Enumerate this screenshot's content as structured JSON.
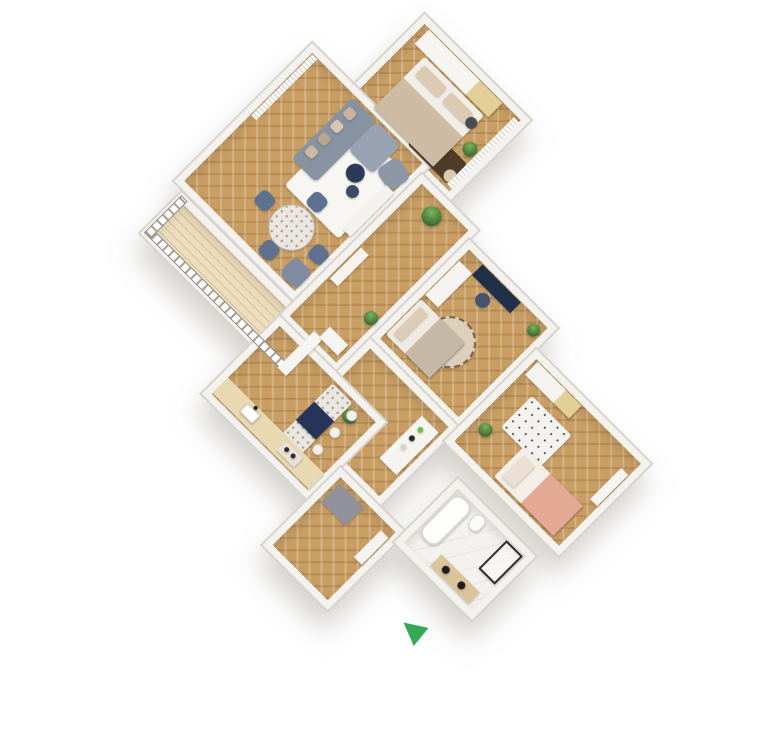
{
  "scene": {
    "description": "3D rendered top-down floor plan of a furnished apartment, rotated diagonally on a white background",
    "background_color": "#ffffff",
    "rotation_deg": 45
  },
  "colors": {
    "wall": "#f3f2ef",
    "wall_edge": "#d7d4ce",
    "wood_floor": "#c99e63",
    "balcony_deck": "#ecddbd",
    "marble_floor": "#f3f2ef",
    "sofa_gray": "#8793a3",
    "navy_accent": "#26345a",
    "beige_textile": "#cdbba4",
    "salmon_textile": "#e3a995",
    "plant_green": "#4c8a42",
    "marker_green": "#34a853"
  },
  "plan": {
    "x": 105,
    "y": 78,
    "width": 560,
    "height": 500,
    "rotation_deg": 45
  },
  "marker": {
    "name": "direction-marker",
    "color": "#34a853",
    "x": 400,
    "y": 614,
    "w": 32,
    "h": 34
  },
  "rooms": [
    {
      "id": "master-bedroom",
      "label": "Master bedroom",
      "floor": "wood",
      "x": 86,
      "y": 0,
      "w": 150,
      "h": 115
    },
    {
      "id": "living-room",
      "label": "Living room",
      "floor": "wood",
      "x": 27,
      "y": 100,
      "w": 170,
      "h": 195
    },
    {
      "id": "balcony",
      "label": "Balcony",
      "floor": "deck",
      "x": 40,
      "y": 298,
      "w": 205,
      "h": 58
    },
    {
      "id": "hallway",
      "label": "Hallway",
      "floor": "wood",
      "x": 197,
      "y": 115,
      "w": 80,
      "h": 201
    },
    {
      "id": "bedroom-2",
      "label": "Bedroom 2",
      "floor": "wood",
      "x": 277,
      "y": 128,
      "w": 125,
      "h": 140
    },
    {
      "id": "corridor",
      "label": "Corridor",
      "floor": "wood",
      "x": 277,
      "y": 268,
      "w": 125,
      "h": 112
    },
    {
      "id": "kitchen",
      "label": "Kitchen",
      "floor": "wood",
      "x": 197,
      "y": 316,
      "w": 150,
      "h": 110
    },
    {
      "id": "entrance",
      "label": "Entrance",
      "floor": "wood",
      "x": 347,
      "y": 380,
      "w": 92,
      "h": 110
    },
    {
      "id": "kids-room",
      "label": "Kids bedroom",
      "floor": "wood",
      "x": 402,
      "y": 158,
      "w": 162,
      "h": 130
    },
    {
      "id": "bathroom",
      "label": "Bathroom",
      "floor": "marble",
      "x": 438,
      "y": 305,
      "w": 110,
      "h": 90
    }
  ],
  "furniture": [
    {
      "name": "wardrobe-master",
      "room": "master-bedroom",
      "shape": "rect",
      "x": 100,
      "y": 8,
      "w": 104,
      "h": 20,
      "color": "#f7f5f2"
    },
    {
      "name": "wardrobe-master-wood",
      "room": "master-bedroom",
      "shape": "rect",
      "x": 172,
      "y": 8,
      "w": 32,
      "h": 20,
      "color": "#e2cf96"
    },
    {
      "name": "rug-master",
      "room": "master-bedroom",
      "shape": "rect",
      "x": 166,
      "y": 76,
      "w": 56,
      "h": 28,
      "color": "#4e3b2a",
      "r": 3
    },
    {
      "name": "bed-master",
      "room": "master-bedroom",
      "shape": "rect",
      "x": 116,
      "y": 30,
      "w": 84,
      "h": 72,
      "color": "#f1eee8",
      "r": 3
    },
    {
      "name": "pillow-master-1",
      "room": "master-bedroom",
      "shape": "rect",
      "x": 122,
      "y": 36,
      "w": 32,
      "h": 14,
      "color": "#dccbb2",
      "r": 3
    },
    {
      "name": "pillow-master-2",
      "room": "master-bedroom",
      "shape": "rect",
      "x": 160,
      "y": 36,
      "w": 32,
      "h": 14,
      "color": "#dccbb2",
      "r": 3
    },
    {
      "name": "blanket-master",
      "room": "master-bedroom",
      "shape": "rect",
      "x": 116,
      "y": 60,
      "w": 84,
      "h": 42,
      "color": "#cdbba4"
    },
    {
      "name": "plant-master",
      "room": "master-bedroom",
      "shape": "circle",
      "x": 206,
      "y": 56,
      "d": 15,
      "texture": "plant"
    },
    {
      "name": "pouf-dark",
      "room": "master-bedroom",
      "shape": "circle",
      "x": 190,
      "y": 38,
      "d": 12,
      "color": "#474c55"
    },
    {
      "name": "pouf-beige",
      "room": "master-bedroom",
      "shape": "circle",
      "x": 212,
      "y": 90,
      "d": 13,
      "color": "#d8cbb4"
    },
    {
      "name": "curtain-master",
      "room": "master-bedroom",
      "shape": "rect",
      "x": 222,
      "y": 10,
      "w": 7,
      "h": 94,
      "texture": "curtain"
    },
    {
      "name": "curtain-living",
      "room": "living-room",
      "shape": "rect",
      "x": 35,
      "y": 108,
      "w": 7,
      "h": 86,
      "texture": "curtain"
    },
    {
      "name": "rug-living",
      "room": "living-room",
      "shape": "rect",
      "x": 108,
      "y": 126,
      "w": 76,
      "h": 94,
      "color": "#f7f6f3",
      "r": 4
    },
    {
      "name": "sofa-body",
      "room": "living-room",
      "shape": "rect",
      "x": 94,
      "y": 110,
      "w": 34,
      "h": 86,
      "color": "#8793a3",
      "r": 5
    },
    {
      "name": "sofa-chaise",
      "room": "living-room",
      "shape": "rect",
      "x": 128,
      "y": 110,
      "w": 34,
      "h": 40,
      "color": "#98a2b2",
      "r": 5
    },
    {
      "name": "sofa-pillow-1",
      "room": "living-room",
      "shape": "rect",
      "x": 98,
      "y": 118,
      "w": 11,
      "h": 11,
      "color": "#c9b49a",
      "r": 3
    },
    {
      "name": "sofa-pillow-2",
      "room": "living-room",
      "shape": "rect",
      "x": 98,
      "y": 136,
      "w": 11,
      "h": 11,
      "color": "#d6c7b2",
      "r": 3
    },
    {
      "name": "sofa-pillow-3",
      "room": "living-room",
      "shape": "rect",
      "x": 98,
      "y": 154,
      "w": 11,
      "h": 11,
      "color": "#b7a58c",
      "r": 3
    },
    {
      "name": "sofa-pillow-4",
      "room": "living-room",
      "shape": "rect",
      "x": 98,
      "y": 172,
      "w": 11,
      "h": 11,
      "color": "#cdb8a0",
      "r": 3
    },
    {
      "name": "coffee-table-1",
      "room": "living-room",
      "shape": "circle",
      "x": 140,
      "y": 152,
      "d": 19,
      "color": "#2c3a57"
    },
    {
      "name": "coffee-table-2",
      "room": "living-room",
      "shape": "circle",
      "x": 154,
      "y": 170,
      "d": 13,
      "color": "#3a4a6b"
    },
    {
      "name": "armchair-1",
      "room": "living-room",
      "shape": "rect",
      "x": 164,
      "y": 122,
      "w": 26,
      "h": 26,
      "color": "#8b96a6",
      "r": 7,
      "rot": 12
    },
    {
      "name": "tv-bench",
      "room": "living-room",
      "shape": "rect",
      "x": 180,
      "y": 148,
      "w": 11,
      "h": 62,
      "color": "#f4f2ee"
    },
    {
      "name": "dining-table",
      "room": "living-room",
      "shape": "circle",
      "x": 120,
      "y": 222,
      "d": 46,
      "texture": "terrazzo",
      "border": "1px solid #cfcbc4"
    },
    {
      "name": "dining-chair-north",
      "room": "living-room",
      "shape": "rect",
      "x": 134,
      "y": 200,
      "w": 18,
      "h": 18,
      "color": "#5e7191",
      "r": 6
    },
    {
      "name": "dining-chair-south",
      "room": "living-room",
      "shape": "rect",
      "x": 134,
      "y": 268,
      "w": 18,
      "h": 18,
      "color": "#5e7191",
      "r": 6
    },
    {
      "name": "dining-chair-west",
      "room": "living-room",
      "shape": "rect",
      "x": 96,
      "y": 236,
      "w": 18,
      "h": 18,
      "color": "#5e7191",
      "r": 6
    },
    {
      "name": "dining-chair-east",
      "room": "living-room",
      "shape": "rect",
      "x": 172,
      "y": 236,
      "w": 18,
      "h": 18,
      "color": "#5e7191",
      "r": 6
    },
    {
      "name": "armchair-2",
      "room": "living-room",
      "shape": "rect",
      "x": 166,
      "y": 262,
      "w": 24,
      "h": 24,
      "color": "#7e8ba0",
      "r": 7
    },
    {
      "name": "balcony-railing-long",
      "room": "balcony",
      "shape": "rect",
      "x": 42,
      "y": 344,
      "w": 201,
      "h": 9,
      "texture": "railing"
    },
    {
      "name": "balcony-railing-end",
      "room": "balcony",
      "shape": "rect",
      "x": 42,
      "y": 300,
      "w": 9,
      "h": 53,
      "texture": "railing-vert"
    },
    {
      "name": "balcony-door-sill",
      "room": "balcony",
      "shape": "rect",
      "x": 232,
      "y": 302,
      "w": 12,
      "h": 52,
      "color": "#f6f5f1"
    },
    {
      "name": "plant-tall-hall",
      "room": "hallway",
      "shape": "circle",
      "x": 224,
      "y": 128,
      "d": 20,
      "texture": "plant"
    },
    {
      "name": "console-hall",
      "room": "hallway",
      "shape": "rect",
      "x": 206,
      "y": 210,
      "w": 11,
      "h": 44,
      "color": "#f5f3ef"
    },
    {
      "name": "plant-hall",
      "room": "hallway",
      "shape": "circle",
      "x": 256,
      "y": 246,
      "d": 14,
      "texture": "plant"
    },
    {
      "name": "side-table-hall",
      "room": "hallway",
      "shape": "rect",
      "x": 240,
      "y": 288,
      "w": 26,
      "h": 15,
      "color": "#f6f5f1"
    },
    {
      "name": "rug-round-bedroom2",
      "room": "bedroom-2",
      "shape": "circle",
      "x": 310,
      "y": 188,
      "d": 52,
      "color": "#dcd0bb",
      "border": "2px dashed #776149"
    },
    {
      "name": "wardrobe-bedroom2",
      "room": "bedroom-2",
      "shape": "rect",
      "x": 285,
      "y": 150,
      "w": 18,
      "h": 48,
      "color": "#f6f4f0"
    },
    {
      "name": "bed-bedroom2",
      "room": "bedroom-2",
      "shape": "rect",
      "x": 285,
      "y": 204,
      "w": 62,
      "h": 50,
      "color": "#efeae2",
      "r": 3
    },
    {
      "name": "pillow-bedroom2",
      "room": "bedroom-2",
      "shape": "rect",
      "x": 290,
      "y": 210,
      "w": 11,
      "h": 38,
      "color": "#dcccb4",
      "r": 2
    },
    {
      "name": "blanket-bedroom2",
      "room": "bedroom-2",
      "shape": "rect",
      "x": 312,
      "y": 204,
      "w": 35,
      "h": 50,
      "color": "#c6b8a6"
    },
    {
      "name": "desk-bedroom2",
      "room": "bedroom-2",
      "shape": "rect",
      "x": 304,
      "y": 136,
      "w": 54,
      "h": 15,
      "color": "#20304a"
    },
    {
      "name": "desk-chair-bedroom2",
      "room": "bedroom-2",
      "shape": "circle",
      "x": 322,
      "y": 154,
      "d": 15,
      "color": "#45546e"
    },
    {
      "name": "plant-bedroom2",
      "room": "bedroom-2",
      "shape": "circle",
      "x": 380,
      "y": 140,
      "d": 13,
      "texture": "plant"
    },
    {
      "name": "bar-shelf",
      "room": "corridor",
      "shape": "rect",
      "x": 368,
      "y": 286,
      "w": 24,
      "h": 60,
      "color": "#f6f4f0"
    },
    {
      "name": "bottle-1",
      "room": "corridor",
      "shape": "circle",
      "x": 374,
      "y": 294,
      "d": 6,
      "color": "#6fbe44"
    },
    {
      "name": "bottle-2",
      "room": "corridor",
      "shape": "circle",
      "x": 374,
      "y": 306,
      "d": 6,
      "color": "#2b2b2b"
    },
    {
      "name": "bottle-3",
      "room": "corridor",
      "shape": "circle",
      "x": 374,
      "y": 318,
      "d": 6,
      "color": "#d8d5cf"
    },
    {
      "name": "plant-corridor",
      "room": "corridor",
      "shape": "circle",
      "x": 310,
      "y": 330,
      "d": 15,
      "texture": "plant"
    },
    {
      "name": "kitchen-island-top",
      "room": "kitchen",
      "shape": "rect",
      "x": 282,
      "y": 326,
      "w": 28,
      "h": 78,
      "texture": "terrazzo",
      "r": 3
    },
    {
      "name": "kitchen-island-navy",
      "room": "kitchen",
      "shape": "rect",
      "x": 282,
      "y": 352,
      "w": 28,
      "h": 26,
      "color": "#26345a"
    },
    {
      "name": "bar-stool-1",
      "room": "kitchen",
      "shape": "circle",
      "x": 313,
      "y": 330,
      "d": 11,
      "color": "#f4f1ec",
      "border": "1px solid #d8d4ce"
    },
    {
      "name": "bar-stool-2",
      "room": "kitchen",
      "shape": "circle",
      "x": 313,
      "y": 354,
      "d": 11,
      "color": "#f4f1ec",
      "border": "1px solid #d8d4ce"
    },
    {
      "name": "bar-stool-3",
      "room": "kitchen",
      "shape": "circle",
      "x": 313,
      "y": 378,
      "d": 11,
      "color": "#f4f1ec",
      "border": "1px solid #d8d4ce"
    },
    {
      "name": "kitchen-counter",
      "room": "kitchen",
      "shape": "rect",
      "x": 204,
      "y": 396,
      "w": 136,
      "h": 22,
      "color": "#e9d9b2"
    },
    {
      "name": "kitchen-sink",
      "room": "kitchen",
      "shape": "rect",
      "x": 236,
      "y": 400,
      "w": 18,
      "h": 12,
      "color": "#ffffff",
      "r": 2,
      "border": "1px solid #cfcbc4"
    },
    {
      "name": "kitchen-faucet",
      "room": "kitchen",
      "shape": "circle",
      "x": 243,
      "y": 396,
      "d": 4,
      "color": "#1e1e1e"
    },
    {
      "name": "cooktop",
      "room": "kitchen",
      "shape": "rect",
      "x": 290,
      "y": 400,
      "w": 24,
      "h": 13,
      "color": "#e8e2d8",
      "r": 2
    },
    {
      "name": "burner-1",
      "room": "kitchen",
      "shape": "circle",
      "x": 294,
      "y": 403,
      "d": 5,
      "color": "#2a2a2a"
    },
    {
      "name": "burner-2",
      "room": "kitchen",
      "shape": "circle",
      "x": 303,
      "y": 403,
      "d": 5,
      "color": "#2a2a2a"
    },
    {
      "name": "entrance-mat",
      "room": "entrance",
      "shape": "rect",
      "x": 358,
      "y": 392,
      "w": 34,
      "h": 26,
      "color": "#90919a",
      "r": 2
    },
    {
      "name": "entrance-console",
      "room": "entrance",
      "shape": "rect",
      "x": 420,
      "y": 396,
      "w": 11,
      "h": 38,
      "color": "#f5f3ef"
    },
    {
      "name": "bathtub",
      "room": "bathroom",
      "shape": "rect",
      "x": 447,
      "y": 314,
      "w": 24,
      "h": 58,
      "color": "#fdfdfc",
      "r": 10,
      "border": "2px solid #dad8d3"
    },
    {
      "name": "toilet",
      "room": "bathroom",
      "shape": "rect",
      "x": 476,
      "y": 314,
      "w": 14,
      "h": 18,
      "color": "#fbfbfa",
      "r": 7,
      "border": "1px solid #d9d6d0"
    },
    {
      "name": "shower",
      "room": "bathroom",
      "shape": "rect",
      "x": 516,
      "y": 314,
      "w": 23,
      "h": 40,
      "color": "rgba(255,255,255,0.35)",
      "border": "2px solid #2e2e2e"
    },
    {
      "name": "bathroom-vanity",
      "room": "bathroom",
      "shape": "rect",
      "x": 480,
      "y": 370,
      "w": 54,
      "h": 16,
      "color": "#dcc49a"
    },
    {
      "name": "vanity-sink-1",
      "room": "bathroom",
      "shape": "circle",
      "x": 490,
      "y": 374,
      "d": 8,
      "color": "#1f1f1f"
    },
    {
      "name": "vanity-sink-2",
      "room": "bathroom",
      "shape": "circle",
      "x": 512,
      "y": 374,
      "d": 8,
      "color": "#1f1f1f"
    },
    {
      "name": "wardrobe-kids",
      "room": "kids-room",
      "shape": "rect",
      "x": 412,
      "y": 166,
      "w": 62,
      "h": 18,
      "color": "#f6f4f0"
    },
    {
      "name": "wardrobe-kids-wood",
      "room": "kids-room",
      "shape": "rect",
      "x": 452,
      "y": 166,
      "w": 22,
      "h": 18,
      "color": "#e2cf96"
    },
    {
      "name": "rug-kids",
      "room": "kids-room",
      "shape": "rect",
      "x": 432,
      "y": 194,
      "w": 56,
      "h": 44,
      "texture": "kidsdots",
      "r": 3
    },
    {
      "name": "bed-kids",
      "room": "kids-room",
      "shape": "rect",
      "x": 462,
      "y": 236,
      "w": 84,
      "h": 42,
      "color": "#f2eee8",
      "r": 3
    },
    {
      "name": "pillow-kids",
      "room": "kids-room",
      "shape": "rect",
      "x": 468,
      "y": 242,
      "w": 16,
      "h": 30,
      "color": "#ece0d4",
      "r": 2
    },
    {
      "name": "blanket-kids",
      "room": "kids-room",
      "shape": "rect",
      "x": 500,
      "y": 236,
      "w": 46,
      "h": 42,
      "color": "#e3a995"
    },
    {
      "name": "shelf-kids",
      "room": "kids-room",
      "shape": "rect",
      "x": 546,
      "y": 182,
      "w": 10,
      "h": 44,
      "color": "#f6f4f0"
    },
    {
      "name": "plant-kids",
      "room": "kids-room",
      "shape": "circle",
      "x": 416,
      "y": 244,
      "d": 14,
      "texture": "plant"
    }
  ]
}
